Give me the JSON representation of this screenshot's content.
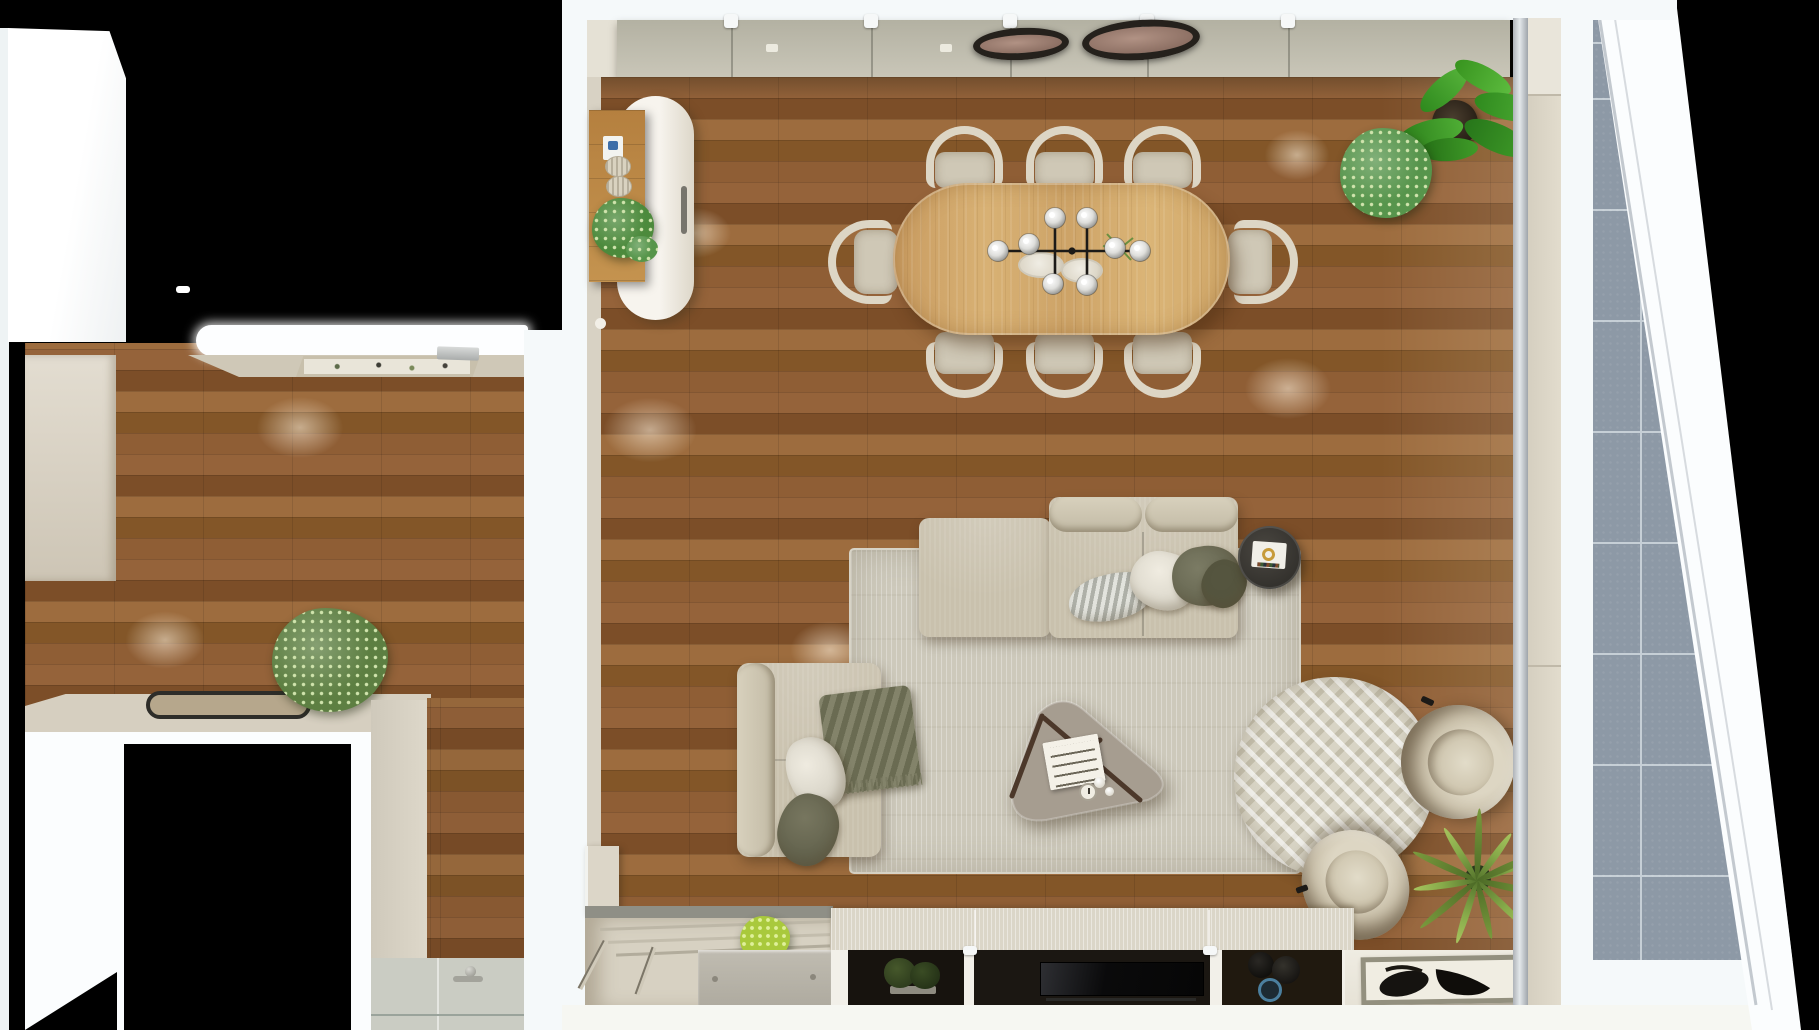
{
  "meta": {
    "view": "top-down-3d-render",
    "rooms": [
      "kitchen",
      "shower-room",
      "living-dining-room",
      "balcony"
    ]
  },
  "palette": {
    "black": "#000000",
    "white": "#f5f9fa",
    "off_white": "#fdfeff",
    "cream": "#d9d3c5",
    "cream_dark": "#c7c0b0",
    "wall_green": "#b7b4a5",
    "wood_base": "#8a5a31",
    "wood_dark": "#7c4e28",
    "wood_light": "#9d6c3e",
    "oak": "#cfa266",
    "rug": "#cdc9bb",
    "rug_round": "#d8d4c5",
    "sofa": "#c9c1ad",
    "sofa_light": "#ddd6c3",
    "pillow_white": "#e6e2d7",
    "olive": "#70705a",
    "olive_dark": "#5c5c47",
    "charcoal": "#3b3935",
    "taupe": "#a69d90",
    "steel": "#c3c6c5",
    "tile_blue": "#8d99a6",
    "grout": "#c6cfd6",
    "shower_tile": "#caccc3",
    "plant_green": "#4f8c44",
    "plant_lime": "#a9c93c",
    "palm_green": "#7fa043",
    "frame_gray": "#93907f",
    "chair_frame": "#ddd6c5",
    "chair_seat": "#cfc8b6",
    "lamp_face": "#a98d7f",
    "inset_black": "#17130e"
  },
  "scene": {
    "kitchen": {
      "label": "kitchen",
      "items": [
        "tall-cabinet",
        "counter",
        "recessed-cooktop",
        "island",
        "half-round-mat",
        "potted-plant"
      ]
    },
    "shower_room": {
      "label": "shower room",
      "items": [
        "wood-wall",
        "shower-tile-floor",
        "drain",
        "glass-partition"
      ]
    },
    "living_dining": {
      "label": "living and dining room",
      "items": [
        "oval-console",
        "wood-wall-shelf",
        "dining-table",
        "dining-chairs",
        "linear-chandelier",
        "ceiling-lamps",
        "sectional-sofa",
        "ottoman",
        "loveseat",
        "side-table",
        "coffee-table",
        "area-rug",
        "round-rug",
        "armchairs",
        "palm-plant",
        "media-bench",
        "tv-screen",
        "moss-art",
        "vases",
        "entry-steps",
        "framed-art-tray"
      ]
    },
    "balcony": {
      "label": "balcony",
      "items": [
        "stone-tiles",
        "diagonal-parapet-wall"
      ]
    },
    "counts": {
      "dining_chairs": 8,
      "chandelier_globes": 8,
      "ceiling_lamps": 2,
      "armchairs": 2,
      "sofas": 2,
      "media_cells": 3,
      "plants": 6
    }
  }
}
